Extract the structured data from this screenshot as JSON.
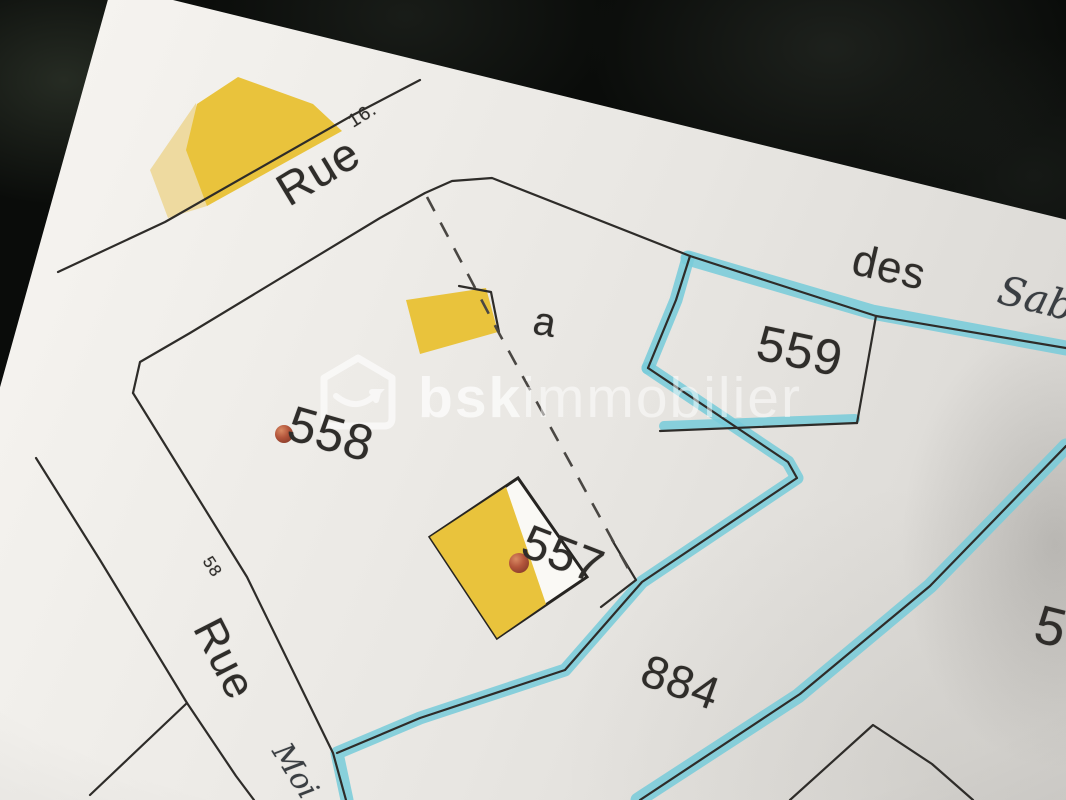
{
  "streets": {
    "top_name": "Rue",
    "top_number": "16.",
    "left_name": "Rue",
    "left_number": "58",
    "east_particle": "des"
  },
  "handwriting": {
    "top_right": "Sab",
    "bottom_left": "Moi"
  },
  "parcels": {
    "p559": "559",
    "p558": "558",
    "p557": "557",
    "p884": "884",
    "partial_right": "5",
    "building_letter": "a"
  },
  "watermark": {
    "brand_bold": "bsk",
    "brand_light": "immobilier"
  },
  "colors": {
    "highlight_blue": "#7accd9",
    "building_yellow": "#e9c33c",
    "building_yellow_pale": "#eedaa0",
    "marker_red": "#b3553b",
    "line": "#2e2c29",
    "paper": "#eceae6",
    "background": "#0a0c0a"
  }
}
